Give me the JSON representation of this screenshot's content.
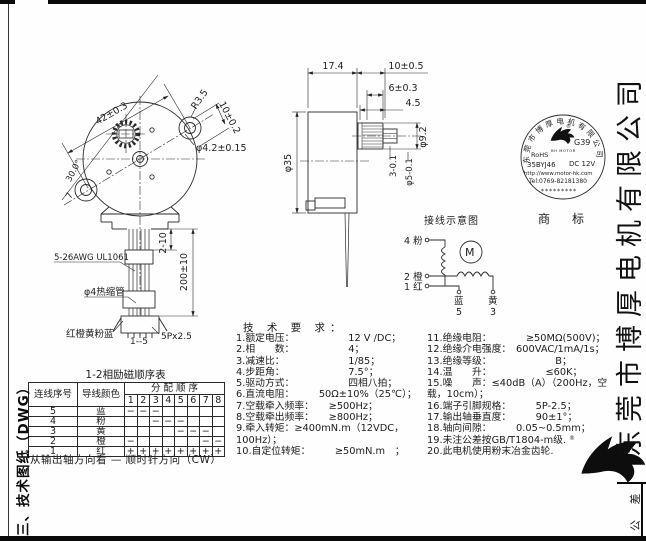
{
  "page": {
    "sidebar_label": "三、技术图纸（DWG）",
    "company_vertical": "东莞市博厚电机有限公司",
    "tolerance_label": "公 差"
  },
  "front_view": {
    "dims": {
      "d42": "42±0.3",
      "r35": "R3.5",
      "d10": "10±0.2",
      "hole": "φ4.2±0.15",
      "a30": "30.0°",
      "n7": "7",
      "wire_spec": "5-26AWG UL1061",
      "shrink": "φ4热缩管",
      "wire_colors": "红橙黄粉蓝",
      "pins": "1--5",
      "conn": "5Px2.5",
      "len1": "2-10",
      "len2": "200±10"
    }
  },
  "side_view": {
    "dims": {
      "w174": "17.4",
      "l10": "10±0.5",
      "l6": "6±0.3",
      "l45": "4.5",
      "d92": "φ9.2",
      "flat3": "3-0.1",
      "d5": "φ5-0.1",
      "d35": "φ35"
    }
  },
  "stamp": {
    "arc": "东莞市博厚电机有限公司",
    "reg": "®",
    "code": "G39",
    "brand": "BH MOTOR",
    "rohs": "RoHS",
    "model": "35BYJ46",
    "voltage": "DC 12V",
    "url": "http://www.motor-hk.com",
    "tel": "Tel:0769-82181380",
    "stars": "*********",
    "caption": "商　标"
  },
  "wiring": {
    "title": "接线示意图",
    "motor": "M",
    "t4": "4 粉",
    "t2": "2 橙",
    "t1": "1 红",
    "b5c": "蓝",
    "b5n": "5",
    "b3c": "黄",
    "b3n": "3"
  },
  "logo": {
    "reg": "®"
  },
  "tech": {
    "header": "技 术 要 求：",
    "left": [
      "1.额定电压：　　　　　　12 V /DC；",
      "2.相　　数：　　　　　　4；",
      "3.减速比：　　　　　　　1/85；",
      "4.步距角：　　　　　　　7.5°；",
      "5.驱动方式：　　　　　　四相八拍；",
      "6.直流电阻：　　　50Ω±10%（25℃）；",
      "7.空载牵入频率：　　≥500Hz；",
      "8.空载牵出频率：　　≥800Hz；",
      "9.牵入转矩：≥400mN.m（12VDC，100Hz）；",
      "10.自定位转矩：　　　≥50mN.m　；"
    ],
    "right": [
      "11.绝缘电阻：　　　　≥50MΩ(500V)；",
      "12.绝缘介电强度：　600VAC/1mA/1s；",
      "13.绝缘等级：　　　　　　　B；",
      "14.温　　升：　　　　　　≤60K；",
      "15.噪　　声：≤40dB（A）（200Hz，空载，10cm）；",
      "16.端子引脚规格：　　　5P-2.5；",
      "17.输出轴垂直度：　　　90±1°；",
      "18.轴向间隙：　　　0.05~0.5mm；",
      "19.未注公差按GB/T1804-m级.",
      "20.此电机使用粉末冶金齿轮."
    ]
  },
  "table": {
    "title": "1-2相励磁顺序表",
    "col_wire": "连线序号",
    "col_color": "导线颜色",
    "col_seq": "分 配 顺 序",
    "steps": [
      "1",
      "2",
      "3",
      "4",
      "5",
      "6",
      "7",
      "8"
    ],
    "rows": [
      {
        "no": "5",
        "color": "蓝",
        "marks": [
          "−",
          "−",
          "−",
          "",
          "",
          "",
          "",
          ""
        ]
      },
      {
        "no": "4",
        "color": "粉",
        "marks": [
          "",
          "",
          "−",
          "−",
          "−",
          "",
          "",
          ""
        ]
      },
      {
        "no": "3",
        "color": "黄",
        "marks": [
          "",
          "",
          "",
          "",
          "−",
          "−",
          "−",
          ""
        ]
      },
      {
        "no": "2",
        "color": "橙",
        "marks": [
          "−",
          "",
          "",
          "",
          "",
          "",
          "−",
          "−"
        ]
      },
      {
        "no": "1",
        "color": "红",
        "marks": [
          "+",
          "+",
          "+",
          "+",
          "+",
          "+",
          "+",
          "+"
        ]
      }
    ],
    "note": "从输出轴方向看 — 顺时针方向（CW）"
  }
}
